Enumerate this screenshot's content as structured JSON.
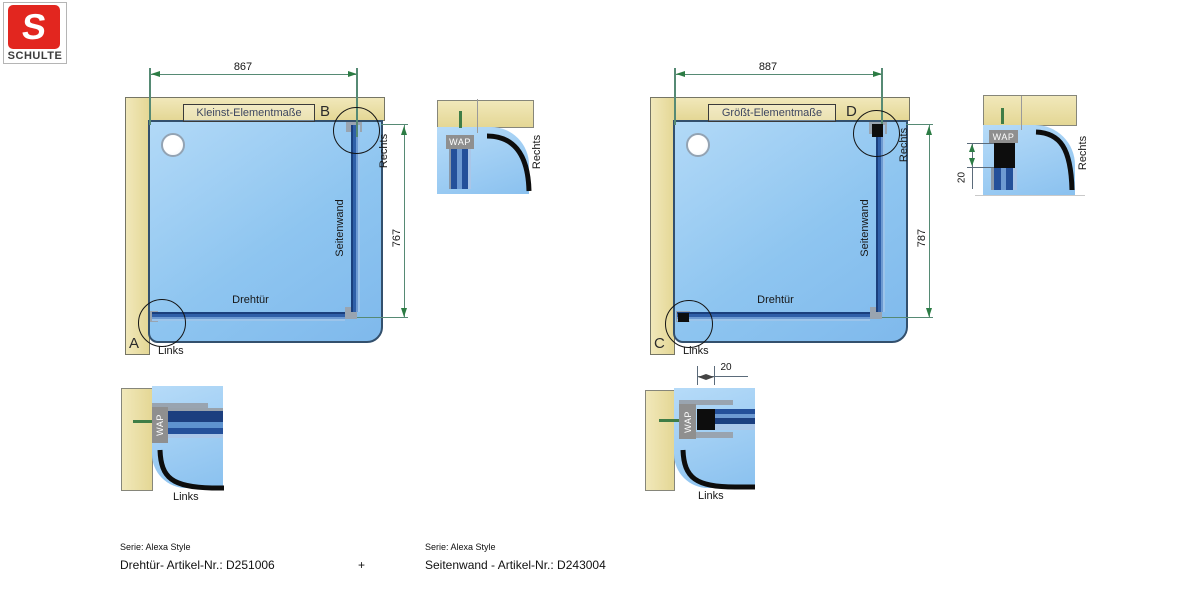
{
  "logo": {
    "letter": "S",
    "brand": "SCHULTE"
  },
  "diagrams": {
    "min": {
      "title": "Kleinst-Elementmaße",
      "width": "867",
      "height": "767",
      "door": "Drehtür",
      "sidewall": "Seitenwand",
      "rechts": "Rechts",
      "links": "Links",
      "detail_top": "B",
      "detail_bottom": "A"
    },
    "max": {
      "title": "Größt-Elementmaße",
      "width": "887",
      "height": "787",
      "door": "Drehtür",
      "sidewall": "Seitenwand",
      "rechts": "Rechts",
      "links": "Links",
      "detail_top": "D",
      "detail_bottom": "C"
    }
  },
  "details": {
    "b": {
      "label": "B",
      "wap": "WAP",
      "side": "Rechts"
    },
    "a": {
      "label": "A",
      "wap": "WAP",
      "side": "Links"
    },
    "d": {
      "label": "D",
      "wap": "WAP",
      "side": "Rechts",
      "dim": "20"
    },
    "c": {
      "label": "C",
      "wap": "WAP",
      "side": "Links",
      "dim": "20"
    }
  },
  "footer": {
    "left_serie": "Serie: Alexa Style",
    "left_article": "Drehtür- Artikel-Nr.: D251006",
    "plus": "+",
    "right_serie": "Serie: Alexa Style",
    "right_article": "Seitenwand - Artikel-Nr.: D243004"
  },
  "colors": {
    "logo_red": "#e2261f",
    "wall_beige": "#eadfa8",
    "tray_blue": "#8cc3f0",
    "profile_blue": "#2f5fa8",
    "dimension_green": "#568a74",
    "wap_gray": "#8f8f8f",
    "detail_black": "#0d0d0d"
  }
}
